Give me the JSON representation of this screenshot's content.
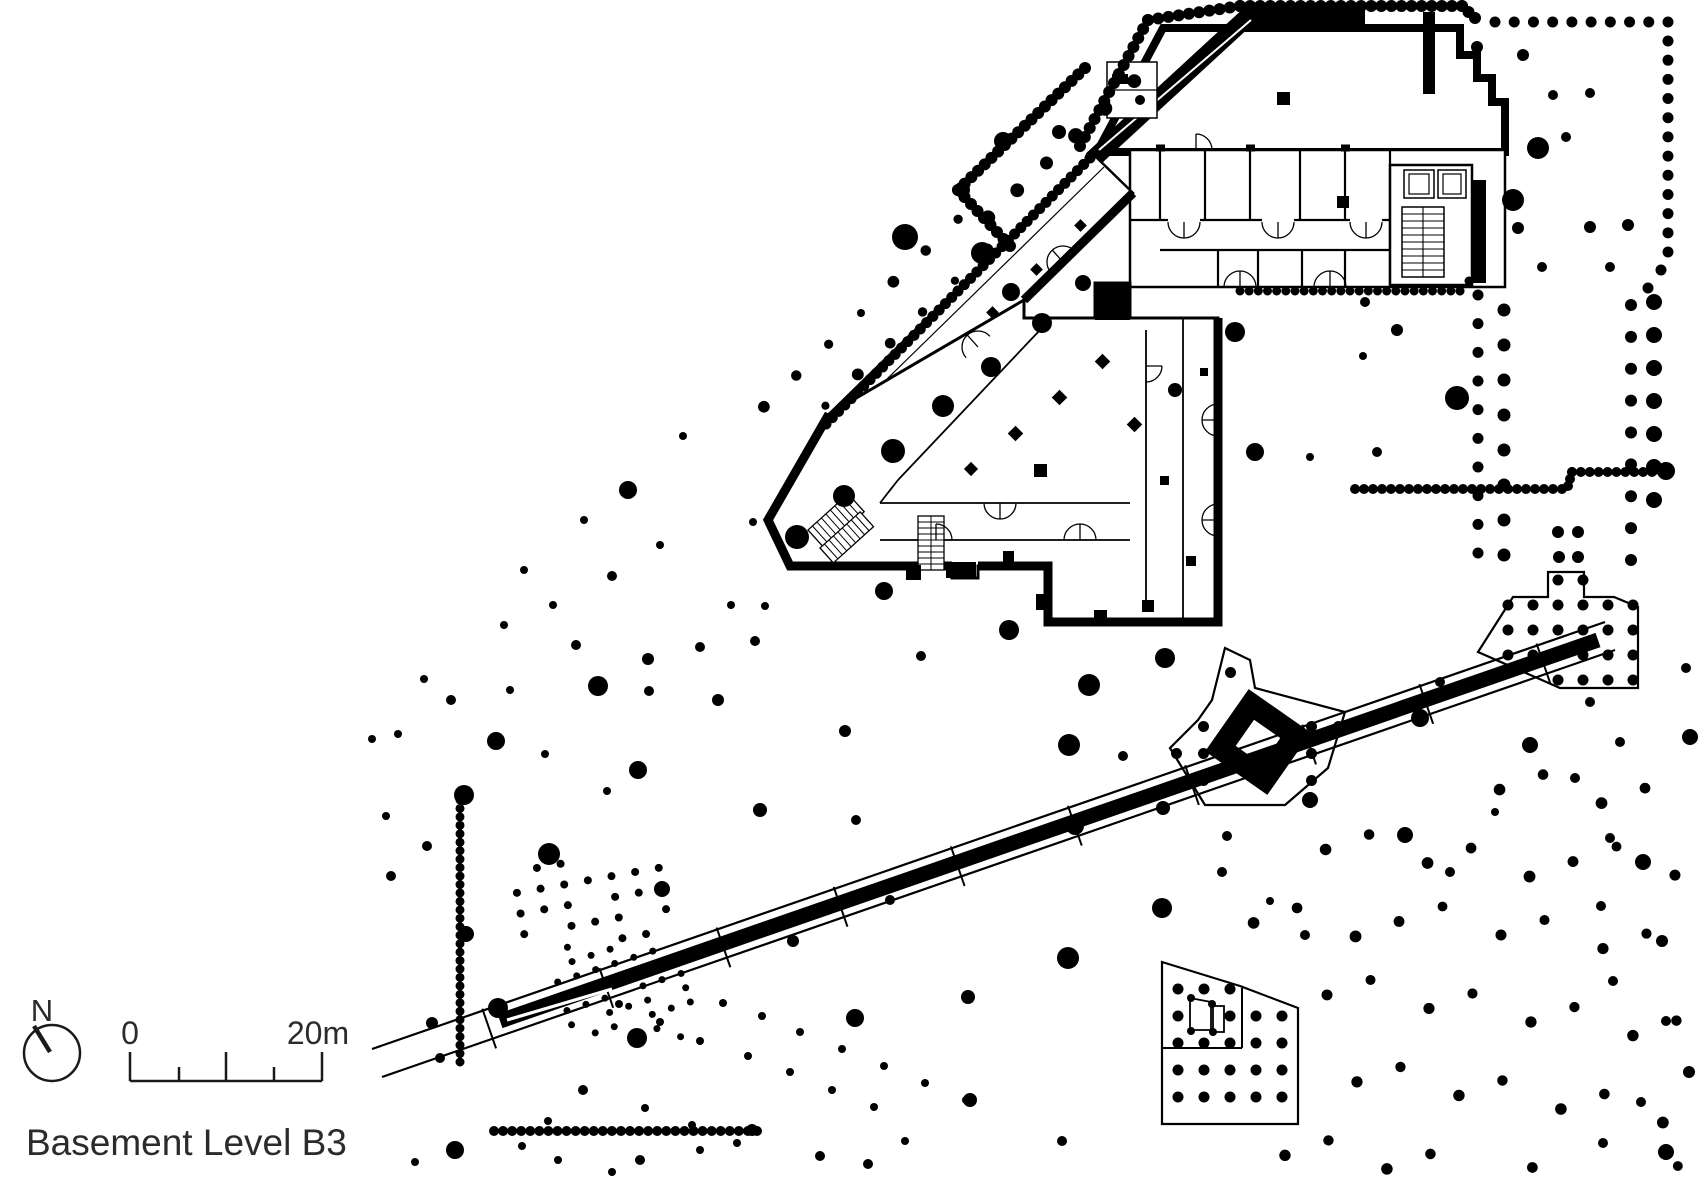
{
  "meta": {
    "title": "Basement Level B3"
  },
  "legend": {
    "north_label": "N",
    "scale_start": "0",
    "scale_end": "20m"
  },
  "colors": {
    "ink": "#000000",
    "bg": "#ffffff",
    "text": "#2b2b2b"
  },
  "drawing": {
    "trees": [
      [
        753,
        522,
        4
      ],
      [
        797,
        537,
        12
      ],
      [
        844,
        496,
        11
      ],
      [
        893,
        451,
        12
      ],
      [
        943,
        406,
        11
      ],
      [
        991,
        367,
        10
      ],
      [
        1042,
        323,
        10
      ],
      [
        1011,
        292,
        9
      ],
      [
        1083,
        283,
        8
      ],
      [
        982,
        253,
        11
      ],
      [
        905,
        237,
        13
      ],
      [
        1003,
        141,
        9
      ],
      [
        1059,
        132,
        7
      ],
      [
        683,
        436,
        4
      ],
      [
        628,
        490,
        9
      ],
      [
        584,
        520,
        4
      ],
      [
        524,
        570,
        4
      ],
      [
        612,
        576,
        5
      ],
      [
        660,
        545,
        4
      ],
      [
        648,
        659,
        6
      ],
      [
        700,
        647,
        5
      ],
      [
        576,
        645,
        5
      ],
      [
        504,
        625,
        4
      ],
      [
        553,
        605,
        4
      ],
      [
        598,
        686,
        10
      ],
      [
        649,
        691,
        5
      ],
      [
        718,
        700,
        6
      ],
      [
        510,
        690,
        4
      ],
      [
        451,
        700,
        5
      ],
      [
        424,
        679,
        4
      ],
      [
        755,
        641,
        5
      ],
      [
        731,
        605,
        4
      ],
      [
        372,
        739,
        4
      ],
      [
        398,
        734,
        4
      ],
      [
        496,
        741,
        9
      ],
      [
        545,
        754,
        4
      ],
      [
        638,
        770,
        9
      ],
      [
        607,
        791,
        4
      ],
      [
        464,
        795,
        10
      ],
      [
        386,
        816,
        4
      ],
      [
        427,
        846,
        5
      ],
      [
        549,
        854,
        11
      ],
      [
        662,
        889,
        8
      ],
      [
        391,
        876,
        5
      ],
      [
        466,
        934,
        8
      ],
      [
        432,
        1023,
        6
      ],
      [
        440,
        1058,
        5
      ],
      [
        498,
        1008,
        10
      ],
      [
        455,
        1150,
        9
      ],
      [
        415,
        1162,
        4
      ],
      [
        548,
        1121,
        4
      ],
      [
        522,
        1146,
        4
      ],
      [
        765,
        606,
        4
      ],
      [
        884,
        591,
        9
      ],
      [
        1009,
        630,
        10
      ],
      [
        921,
        656,
        5
      ],
      [
        845,
        731,
        6
      ],
      [
        760,
        810,
        7
      ],
      [
        856,
        820,
        5
      ],
      [
        890,
        900,
        5
      ],
      [
        793,
        941,
        6
      ],
      [
        855,
        1018,
        9
      ],
      [
        968,
        997,
        7
      ],
      [
        1068,
        958,
        11
      ],
      [
        637,
        1038,
        10
      ],
      [
        752,
        1130,
        6
      ],
      [
        820,
        1156,
        5
      ],
      [
        868,
        1164,
        5
      ],
      [
        905,
        1141,
        4
      ],
      [
        970,
        1100,
        7
      ],
      [
        1062,
        1141,
        5
      ],
      [
        1165,
        658,
        10
      ],
      [
        1089,
        685,
        11
      ],
      [
        1069,
        745,
        11
      ],
      [
        1163,
        808,
        7
      ],
      [
        1075,
        826,
        9
      ],
      [
        1123,
        756,
        5
      ],
      [
        1188,
        786,
        4
      ],
      [
        1227,
        836,
        5
      ],
      [
        1310,
        800,
        8
      ],
      [
        1222,
        872,
        5
      ],
      [
        1162,
        908,
        10
      ],
      [
        1305,
        935,
        5
      ],
      [
        1270,
        901,
        4
      ],
      [
        1235,
        332,
        10
      ],
      [
        1175,
        390,
        7
      ],
      [
        1255,
        452,
        9
      ],
      [
        1310,
        457,
        4
      ],
      [
        1365,
        302,
        5
      ],
      [
        1397,
        330,
        6
      ],
      [
        1363,
        356,
        4
      ],
      [
        1457,
        398,
        12
      ],
      [
        1377,
        452,
        5
      ],
      [
        1420,
        718,
        9
      ],
      [
        1440,
        682,
        5
      ],
      [
        1530,
        745,
        8
      ],
      [
        1405,
        835,
        8
      ],
      [
        1575,
        778,
        5
      ],
      [
        1495,
        812,
        4
      ],
      [
        1450,
        872,
        5
      ],
      [
        1590,
        702,
        5
      ],
      [
        1686,
        668,
        5
      ],
      [
        1620,
        742,
        5
      ],
      [
        1690,
        737,
        8
      ],
      [
        1643,
        862,
        8
      ],
      [
        1610,
        838,
        5
      ],
      [
        1601,
        906,
        5
      ],
      [
        1662,
        941,
        6
      ],
      [
        1613,
        981,
        5
      ],
      [
        1666,
        1021,
        5
      ],
      [
        1689,
        1072,
        6
      ],
      [
        1641,
        1102,
        5
      ],
      [
        1603,
        1143,
        5
      ],
      [
        1666,
        1152,
        8
      ],
      [
        1523,
        55,
        6
      ],
      [
        1553,
        95,
        5
      ],
      [
        1590,
        93,
        5
      ],
      [
        1538,
        148,
        11
      ],
      [
        1513,
        200,
        11
      ],
      [
        1566,
        137,
        5
      ],
      [
        1518,
        228,
        6
      ],
      [
        1590,
        227,
        6
      ],
      [
        1628,
        225,
        6
      ],
      [
        1542,
        267,
        5
      ],
      [
        1610,
        267,
        5
      ],
      [
        1477,
        47,
        6
      ],
      [
        1558,
        532,
        6
      ],
      [
        1578,
        532,
        6
      ],
      [
        1559,
        557,
        6
      ],
      [
        1578,
        557,
        6
      ],
      [
        723,
        1003,
        4
      ],
      [
        762,
        1016,
        4
      ],
      [
        800,
        1032,
        4
      ],
      [
        842,
        1049,
        4
      ],
      [
        884,
        1066,
        4
      ],
      [
        925,
        1083,
        4
      ],
      [
        966,
        1100,
        4
      ],
      [
        748,
        1056,
        4
      ],
      [
        790,
        1072,
        4
      ],
      [
        832,
        1090,
        4
      ],
      [
        874,
        1107,
        4
      ],
      [
        700,
        1041,
        4
      ],
      [
        660,
        1022,
        4
      ],
      [
        619,
        1004,
        4
      ],
      [
        583,
        1090,
        5
      ],
      [
        645,
        1108,
        4
      ],
      [
        692,
        1125,
        4
      ],
      [
        737,
        1143,
        4
      ],
      [
        640,
        1160,
        5
      ],
      [
        700,
        1150,
        4
      ],
      [
        558,
        1160,
        4
      ],
      [
        612,
        1172,
        4
      ],
      [
        1666,
        471,
        9
      ],
      [
        1191,
        998,
        4
      ],
      [
        1212,
        1004,
        4
      ],
      [
        1191,
        1031,
        4
      ],
      [
        1213,
        1032,
        4
      ]
    ],
    "bead_lines": [
      {
        "pts": [
          [
            1080,
            146
          ],
          [
            1148,
            20
          ],
          [
            1240,
            6
          ],
          [
            1462,
            6
          ],
          [
            1475,
            18
          ]
        ],
        "r": 6,
        "step": 10
      },
      {
        "pts": [
          [
            958,
            190
          ],
          [
            1085,
            68
          ]
        ],
        "r": 6,
        "step": 9.5
      },
      {
        "pts": [
          [
            958,
            190
          ],
          [
            1010,
            246
          ]
        ],
        "r": 6,
        "step": 9.5
      },
      {
        "pts": [
          [
            1090,
            158
          ],
          [
            826,
            424
          ]
        ],
        "r": 5.5,
        "step": 9
      },
      {
        "pts": [
          [
            1240,
            291
          ],
          [
            1460,
            291
          ],
          [
            1469,
            281
          ]
        ],
        "r": 4.5,
        "step": 9
      },
      {
        "pts": [
          [
            1355,
            489
          ],
          [
            1562,
            489
          ]
        ],
        "r": 5,
        "step": 9
      },
      {
        "pts": [
          [
            1568,
            486
          ],
          [
            1572,
            472
          ],
          [
            1652,
            472
          ]
        ],
        "r": 5,
        "step": 9
      },
      {
        "pts": [
          [
            460,
            800
          ],
          [
            460,
            1062
          ]
        ],
        "r": 4.5,
        "step": 8.5
      },
      {
        "pts": [
          [
            494,
            1131
          ],
          [
            757,
            1131
          ]
        ],
        "r": 5,
        "step": 9
      }
    ],
    "dot_rows": [
      {
        "from": [
          1495,
          22
        ],
        "to": [
          1668,
          22
        ],
        "n": 10,
        "r": 5.5
      },
      {
        "from": [
          1668,
          41
        ],
        "to": [
          1668,
          252
        ],
        "n": 12,
        "r": 5.5
      },
      {
        "from": [
          1661,
          270
        ],
        "to": [
          1648,
          288
        ],
        "n": 2,
        "r": 5.5
      },
      {
        "from": [
          1631,
          305
        ],
        "to": [
          1631,
          560
        ],
        "n": 9,
        "r": 6
      },
      {
        "from": [
          1654,
          302
        ],
        "to": [
          1654,
          500
        ],
        "n": 7,
        "r": 8
      },
      {
        "from": [
          1478,
          295
        ],
        "to": [
          1478,
          553
        ],
        "n": 10,
        "r": 5.5
      },
      {
        "from": [
          1504,
          310
        ],
        "to": [
          1504,
          555
        ],
        "n": 8,
        "r": 6.5
      }
    ],
    "dot_fields": [
      {
        "poly": [
          [
            958,
            190
          ],
          [
            1135,
            80
          ],
          [
            1097,
            152
          ],
          [
            1010,
            246
          ]
        ],
        "su": 40,
        "sv": 38,
        "angle": -43,
        "r": [
          6.5,
          8
        ]
      },
      {
        "poly": [
          [
            1008,
            254
          ],
          [
            832,
            428
          ],
          [
            714,
            406
          ],
          [
            944,
            198
          ]
        ],
        "su": 45,
        "sv": 42,
        "angle": -44,
        "r": [
          4,
          6.5
        ]
      },
      {
        "poly": [
          [
            1513,
            597
          ],
          [
            1548,
            597
          ],
          [
            1548,
            572
          ],
          [
            1584,
            572
          ],
          [
            1584,
            597
          ],
          [
            1614,
            597
          ],
          [
            1638,
            607
          ],
          [
            1638,
            688
          ],
          [
            1560,
            688
          ],
          [
            1478,
            652
          ]
        ],
        "su": 25,
        "sv": 25,
        "angle": 0,
        "r": 5.5
      },
      {
        "poly": [
          [
            1162,
            962
          ],
          [
            1240,
            986
          ],
          [
            1298,
            1008
          ],
          [
            1298,
            1124
          ],
          [
            1162,
            1124
          ]
        ],
        "su": 26,
        "sv": 27,
        "angle": 0,
        "r": 5.5,
        "excludes": [
          [
            1184,
            992,
            46,
            46
          ]
        ]
      },
      {
        "poly": [
          [
            1225,
            648
          ],
          [
            1250,
            660
          ],
          [
            1255,
            688
          ],
          [
            1345,
            712
          ],
          [
            1328,
            768
          ],
          [
            1285,
            805
          ],
          [
            1205,
            805
          ],
          [
            1170,
            748
          ],
          [
            1198,
            720
          ],
          [
            1212,
            700
          ]
        ],
        "su": 27,
        "sv": 27,
        "angle": 0,
        "r": 5.5,
        "excludes": [
          [
            1205,
            690,
            106,
            106
          ]
        ]
      },
      {
        "poly": [
          [
            1215,
            875
          ],
          [
            1700,
            722
          ],
          [
            1700,
            1178
          ],
          [
            1215,
            1178
          ]
        ],
        "su": 46,
        "sv": 46,
        "angle": -19,
        "r": [
          4,
          6
        ],
        "skip": 0.45,
        "excludes": [
          [
            1150,
            950,
            160,
            180
          ]
        ]
      },
      {
        "poly": [
          [
            515,
            862
          ],
          [
            668,
            862
          ],
          [
            668,
            940
          ],
          [
            515,
            940
          ]
        ],
        "su": 24,
        "sv": 21,
        "angle": -10,
        "r": 4,
        "skip": 0.12
      },
      {
        "poly": [
          [
            556,
            946
          ],
          [
            692,
            946
          ],
          [
            692,
            1038
          ],
          [
            556,
            1038
          ]
        ],
        "su": 20,
        "sv": 15,
        "angle": -18,
        "r": 3.5,
        "skip": 0.15
      }
    ],
    "road": {
      "border_nw": [
        [
          372,
          1049
        ],
        [
          1605,
          622
        ]
      ],
      "border_se": [
        [
          382,
          1077
        ],
        [
          1615,
          650
        ]
      ],
      "band": [
        [
          500,
          1021
        ],
        [
          1598,
          640
        ]
      ],
      "band_w": 15,
      "tick_ts": [
        0.09,
        0.185,
        0.28,
        0.375,
        0.47,
        0.565,
        0.66,
        0.755,
        0.85,
        0.945
      ],
      "tip_slit": [
        [
          507,
          1020
        ],
        [
          612,
          989
        ]
      ]
    }
  }
}
